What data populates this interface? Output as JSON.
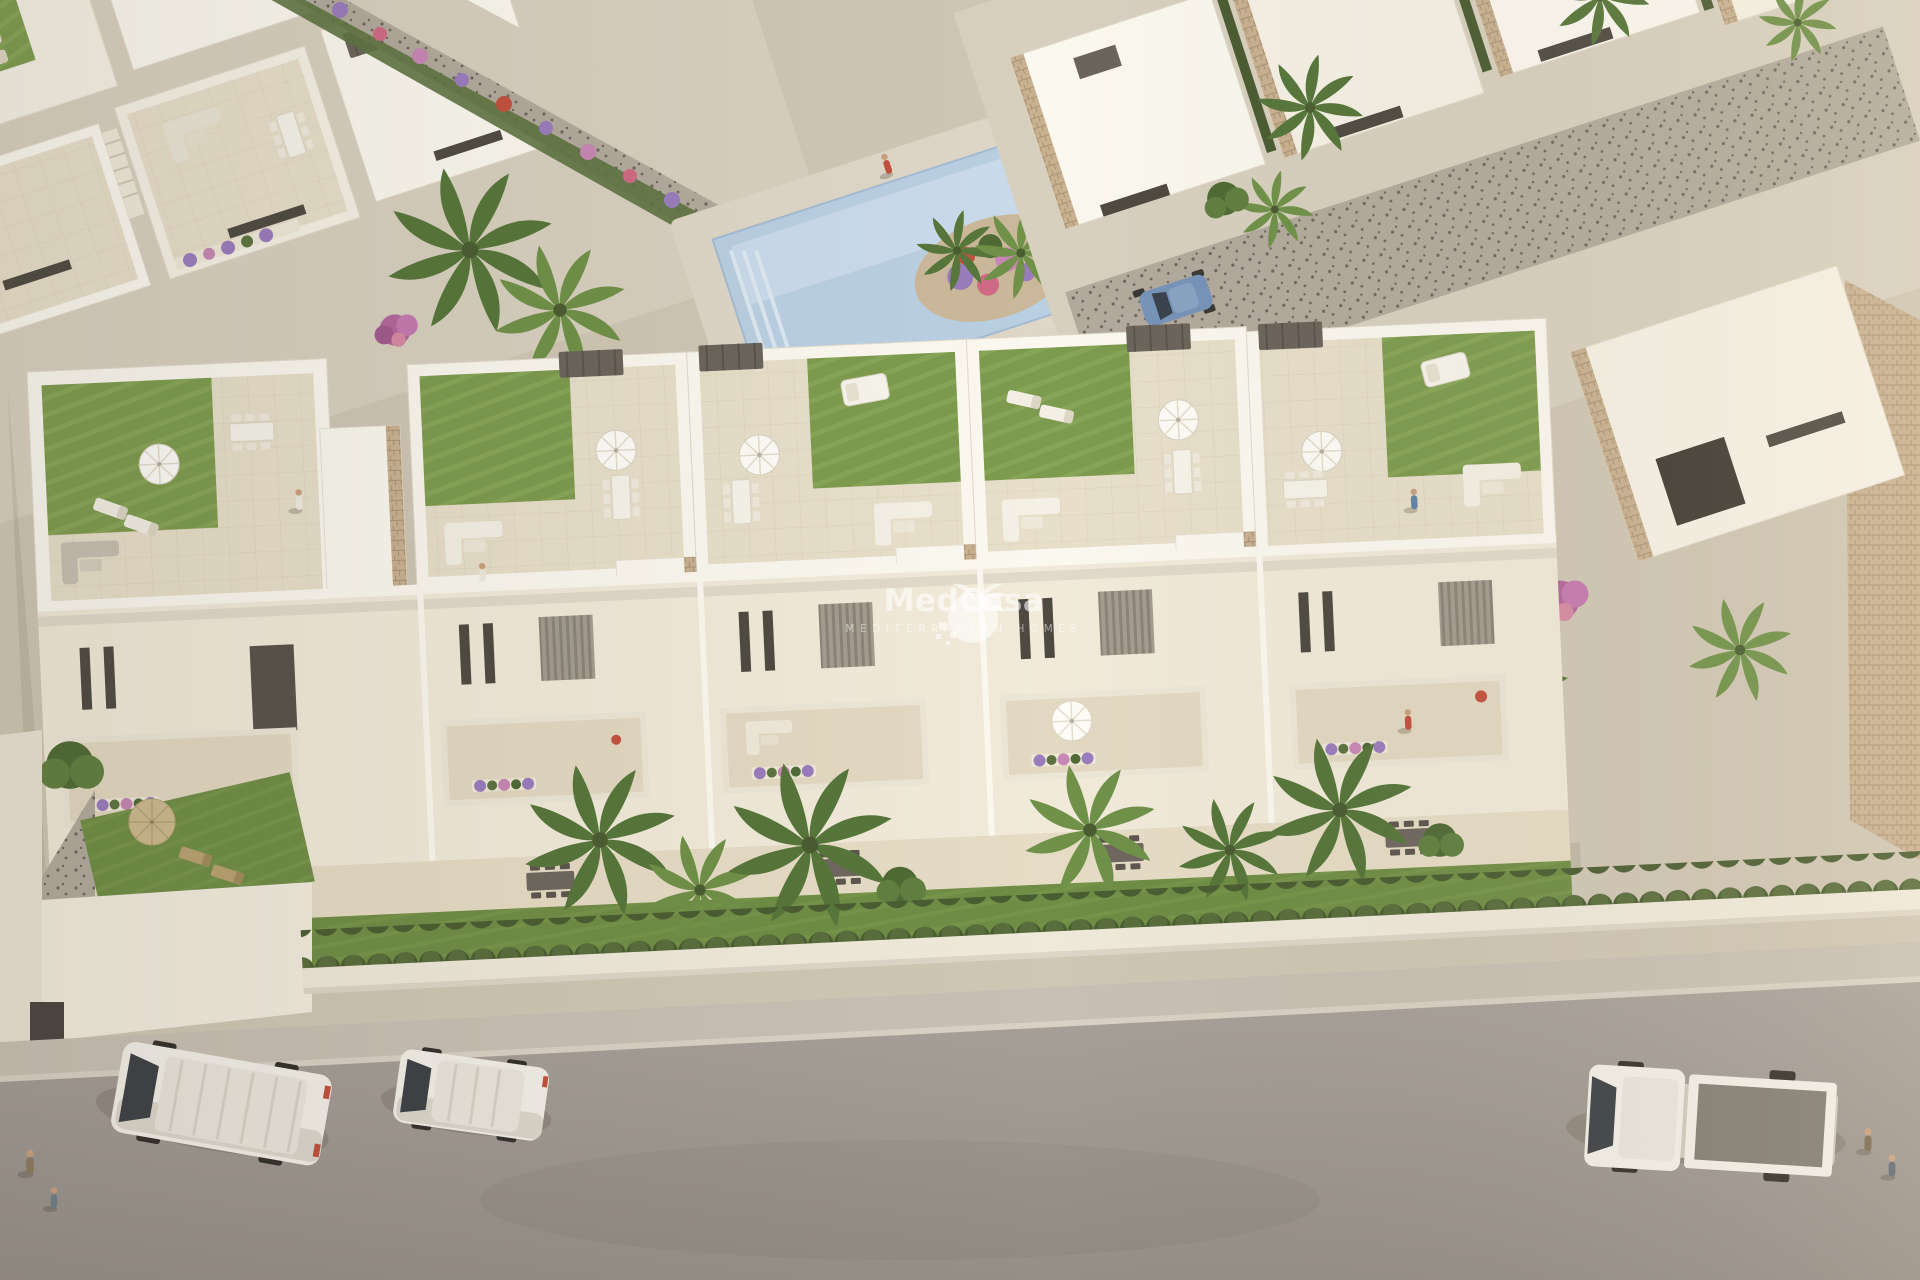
{
  "watermark": {
    "title": "MedCasa",
    "subtitle": "MEDITERRANEAN HOMES",
    "logo_icon": "palm-tree-circle-pixel-logo",
    "text_color": "#ffffff",
    "opacity": 0.95
  },
  "scene": {
    "type": "aerial-architectural-render",
    "description": "Aerial 3D render of a new-build row of white Mediterranean townhouses with rooftop lawn terraces, parasols, balconies with flowers, private gardens behind a hedge wall, a communal pool with banana-palm island among neighbouring villas, and a grey street with parked white vehicles.",
    "palette": {
      "ground": "#cfc6b4",
      "plaza": "#d8d0bf",
      "building-white": "#fbf8f0",
      "building-sunlit": "#f6f1e6",
      "building-shadow": "#ddd5c6",
      "facade-warm": "#f1ead9",
      "terrace-tile": "#e8dfca",
      "terrace-shade": "#d9cfba",
      "window-dark": "#4e4a42",
      "lawn": "#7d9b4e",
      "lawn-light": "#93b15f",
      "lawn-dark": "#6f8d45",
      "hedge": "#4a5c31",
      "hedge-light": "#5d7340",
      "palm": "#56763a",
      "palm-light": "#6f9148",
      "pool-water": "#b9cfe2",
      "pool-light": "#cfdeed",
      "road": "#a9a29b",
      "sidewalk": "#c8c0b4",
      "gravel": "#b2aa9c",
      "gravel-dark": "#6e675f",
      "stone": "#c9b190",
      "pergola": "#6b645b",
      "furn-gray": "#b7b0a4",
      "flower-purple": "#9a7cbd",
      "flower-pink": "#c887b4",
      "flower-rose": "#d06a86",
      "flower-red": "#c2503e",
      "car-blue": "#7693b9",
      "straw": "#cdb98f"
    },
    "vehicles": [
      {
        "name": "panel-van",
        "color": "#f2efe8",
        "location": "street-left"
      },
      {
        "name": "compact-van",
        "color": "#f2efe8",
        "location": "street-center-left"
      },
      {
        "name": "flatbed-truck",
        "color": "#f2efe8",
        "location": "street-right"
      },
      {
        "name": "hatchback",
        "color": "#7693b9",
        "location": "driveway-top-right"
      }
    ],
    "landmarks": [
      "communal-pool",
      "rooftop-terraces",
      "private-gardens",
      "hedge-wall",
      "street"
    ],
    "people_visible": 10
  }
}
